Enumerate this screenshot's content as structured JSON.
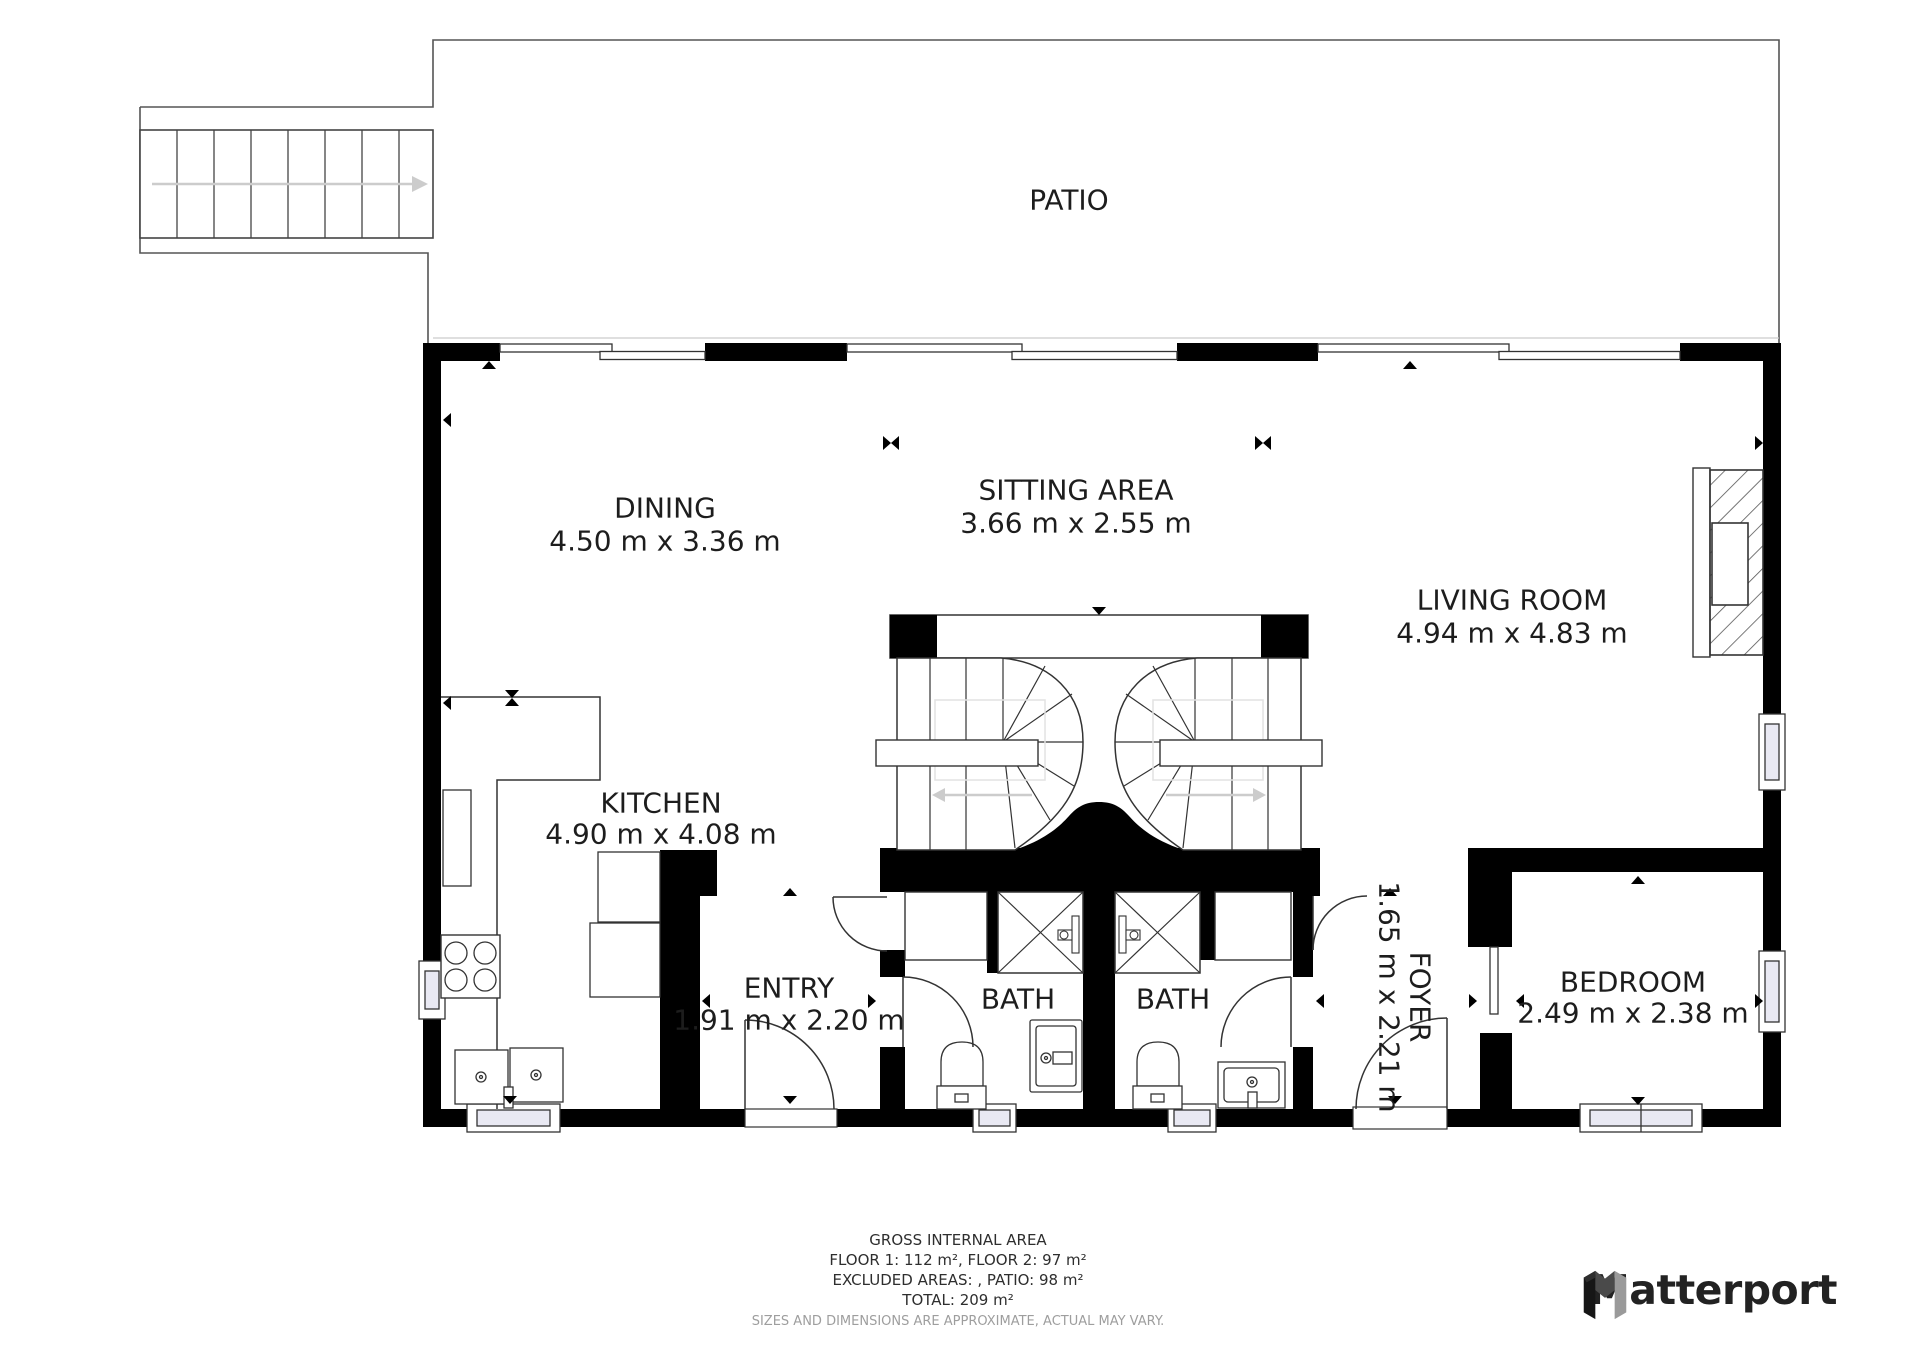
{
  "plan": {
    "patio": {
      "name": "PATIO"
    },
    "rooms": {
      "dining": {
        "name": "DINING",
        "dims": "4.50 m x 3.36 m"
      },
      "sitting": {
        "name": "SITTING AREA",
        "dims": "3.66 m x 2.55 m"
      },
      "living": {
        "name": "LIVING ROOM",
        "dims": "4.94 m x 4.83 m"
      },
      "kitchen": {
        "name": "KITCHEN",
        "dims": "4.90 m x 4.08 m"
      },
      "entry": {
        "name": "ENTRY",
        "dims": "1.91 m x 2.20 m"
      },
      "bath1": {
        "name": "BATH"
      },
      "bath2": {
        "name": "BATH"
      },
      "foyer": {
        "name": "FOYER",
        "dims": "1.65 m x 2.21 m"
      },
      "bedroom": {
        "name": "BEDROOM",
        "dims": "2.49 m x 2.38 m"
      }
    }
  },
  "footer": {
    "line1": "GROSS INTERNAL AREA",
    "line2": "FLOOR 1: 112 m², FLOOR 2: 97 m²",
    "line3": "EXCLUDED AREAS: , PATIO: 98 m²",
    "line4": "TOTAL: 209 m²",
    "disclaimer": "SIZES AND DIMENSIONS ARE APPROXIMATE, ACTUAL MAY VARY."
  },
  "branding": {
    "name": "Matterport"
  },
  "colors": {
    "wall": "#000000",
    "line": "#333333",
    "window_fill": "#e9e9f3",
    "arrow_gray": "#cccccc",
    "text": "#1d1d1d",
    "footer_muted": "#9e9e9e",
    "logo_dark": "#161616",
    "logo_mid": "#4a4a4a",
    "logo_light": "#9a9a9a"
  }
}
